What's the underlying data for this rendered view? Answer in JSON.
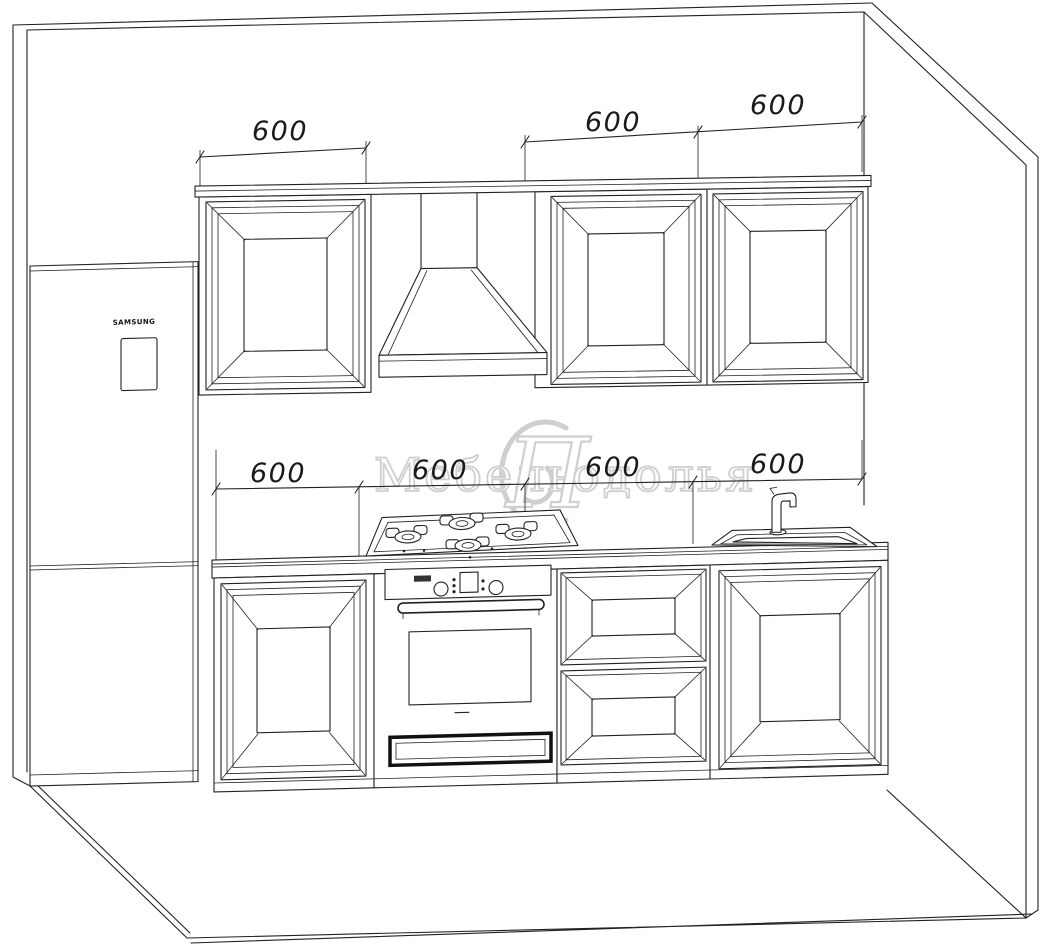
{
  "dims": {
    "top": [
      "600",
      "600",
      "600"
    ],
    "middle": [
      "600",
      "600",
      "600",
      "600"
    ]
  },
  "fridge": {
    "brand": "SAMSUNG"
  },
  "watermark": {
    "word1": "Мебель",
    "monogram": "П",
    "word2": "одолья"
  },
  "colors": {
    "line": "#222222",
    "watermark": "#c7c7c7",
    "background": "#ffffff"
  }
}
